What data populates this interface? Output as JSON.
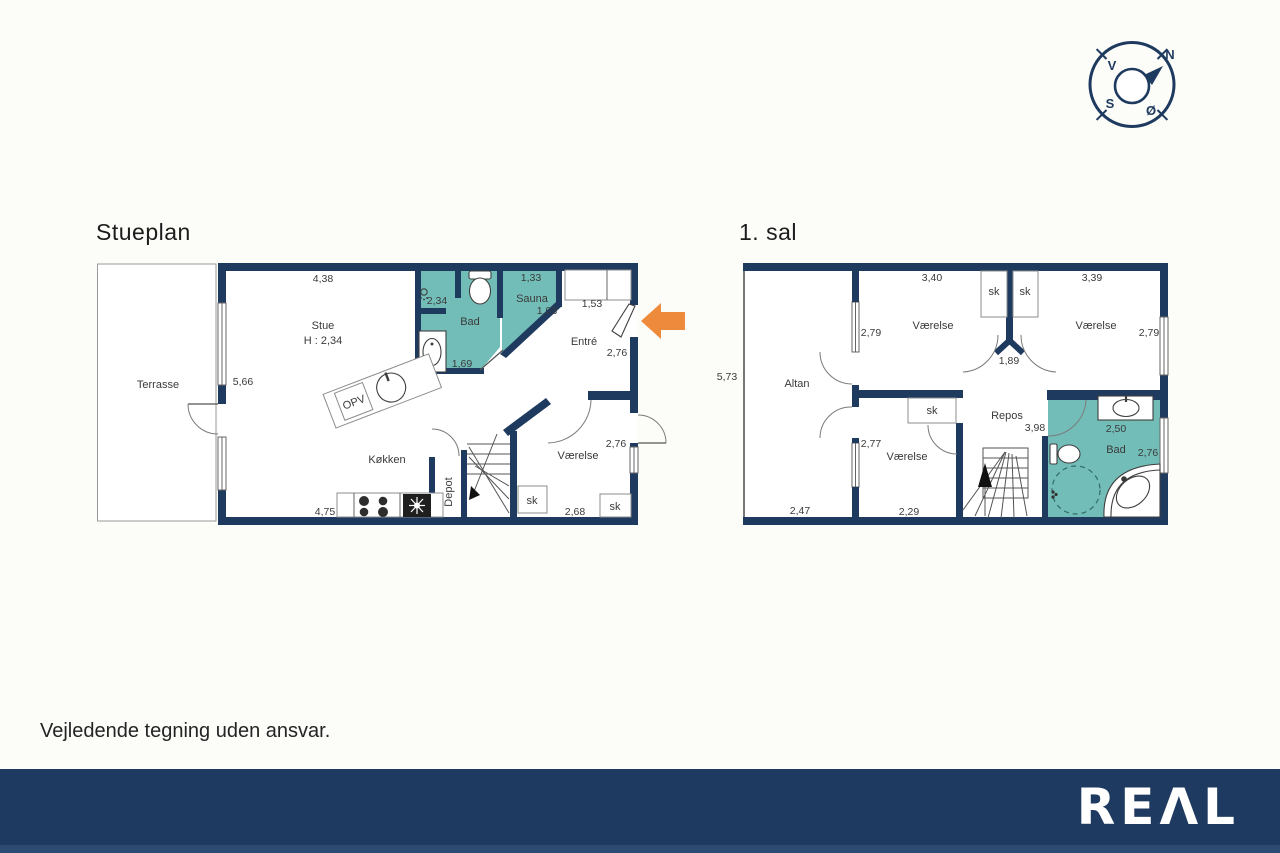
{
  "titles": {
    "ground_floor": "Stueplan",
    "first_floor": "1. sal"
  },
  "disclaimer": "Vejledende tegning uden ansvar.",
  "brand": {
    "logo_text": "REΛL"
  },
  "compass": {
    "north": "N",
    "south": "S",
    "east": "Ø",
    "west": "V"
  },
  "colors": {
    "wall_navy": "#1e3a5f",
    "wet_room_teal": "#73bdb8",
    "entrance_arrow_orange": "#ee8a3c",
    "footer_navy": "#1f3a60"
  },
  "ground_floor": {
    "rooms": {
      "terrasse": "Terrasse",
      "stue": "Stue",
      "stue_height": "H : 2,34",
      "bad": "Bad",
      "sauna": "Sauna",
      "entre": "Entré",
      "koekken": "Køkken",
      "depot": "Depot",
      "vaerelse": "Værelse",
      "opv": "OPV",
      "sk_stair": "sk",
      "sk_vaerelse": "sk"
    },
    "dims": {
      "stue_width": "4,38",
      "terrasse_depth": "5,66",
      "bad_width": "2,34",
      "bad_length": "1,69",
      "sauna_width": "1,33",
      "sauna_depth": "1,03",
      "entre_width": "1,53",
      "entre_depth": "2,76",
      "koekken_width": "4,75",
      "vaerelse_depth": "2,76",
      "vaerelse_width": "2,68"
    }
  },
  "first_floor": {
    "rooms": {
      "altan": "Altan",
      "vaerelse_nw": "Værelse",
      "vaerelse_ne": "Værelse",
      "vaerelse_sw": "Værelse",
      "repos": "Repos",
      "bad": "Bad",
      "sk_nw": "sk",
      "sk_ne": "sk",
      "sk_sw": "sk"
    },
    "dims": {
      "floor_depth": "5,73",
      "nw_width": "3,40",
      "nw_depth": "2,79",
      "ne_width": "3,39",
      "ne_depth": "2,79",
      "door_gap": "1,89",
      "altan_width": "2,47",
      "sw_depth": "2,77",
      "sw_width": "2,29",
      "repos_length": "3,98",
      "bad_width": "2,50",
      "bad_depth": "2,76"
    }
  }
}
